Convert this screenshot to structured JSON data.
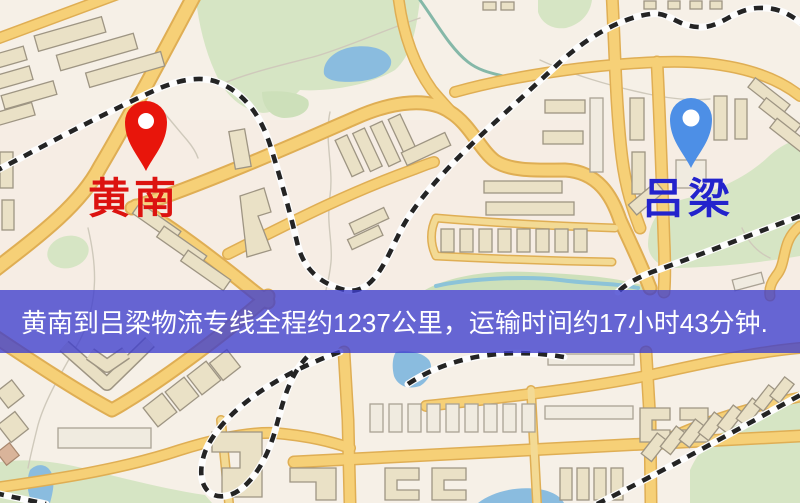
{
  "map": {
    "origin": {
      "label": "黄南",
      "pin_color": "#e8150b",
      "label_color": "#dc1310"
    },
    "destination": {
      "label": "吕梁",
      "pin_color": "#4d8fe6",
      "label_color": "#2323cc"
    }
  },
  "banner": {
    "text": "黄南到吕梁物流专线全程约1237公里，运输时间约17小时43分钟.",
    "overlay_color": "#3e3ecd",
    "text_color": "#ffffff"
  },
  "route": {
    "from": "黄南",
    "to": "吕梁",
    "distance": "约1237公里",
    "duration": "约17小时43分钟"
  }
}
